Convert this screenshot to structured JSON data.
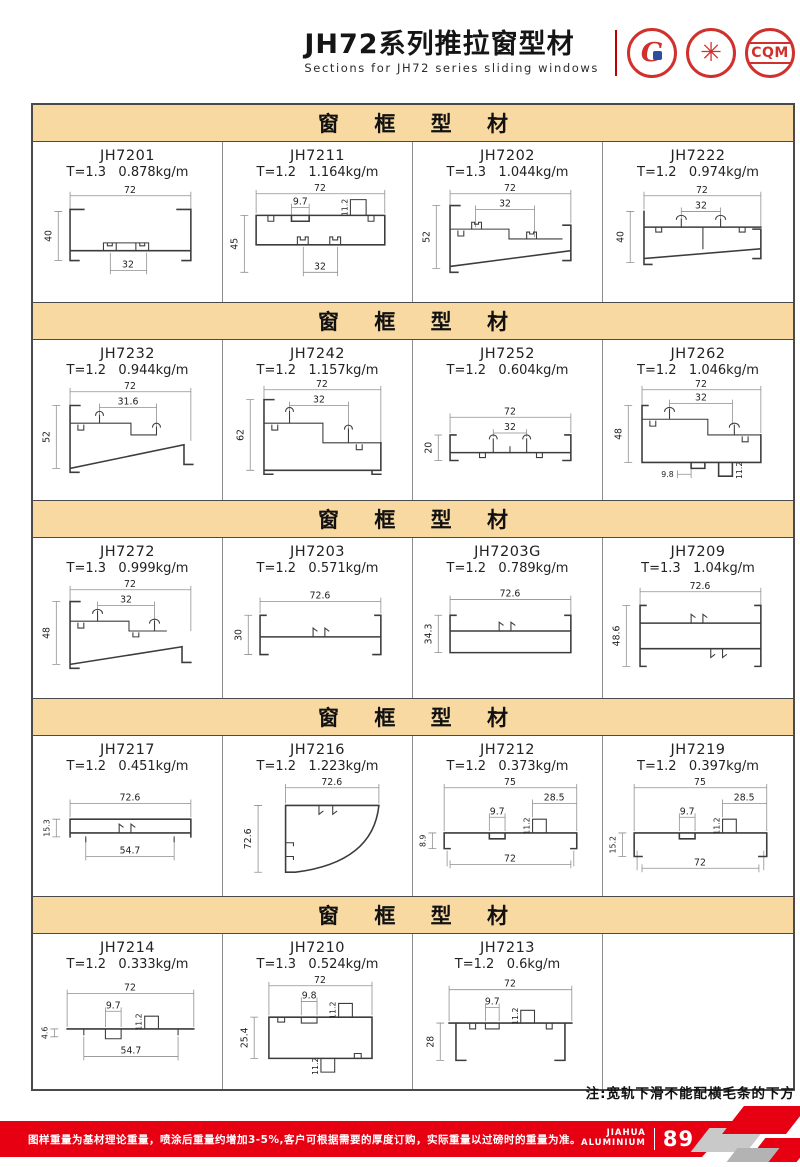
{
  "header": {
    "title": "JH72系列推拉窗型材",
    "subtitle": "Sections for JH72 series sliding windows",
    "seals": {
      "cqm_label": "CQM"
    }
  },
  "sections": [
    {
      "title": "窗 框 型 材",
      "cells": [
        {
          "model": "JH7201",
          "spec": "T=1.3   0.878kg/m",
          "dims": {
            "w": "72",
            "h": "40",
            "a": "32"
          }
        },
        {
          "model": "JH7211",
          "spec": "T=1.2   1.164kg/m",
          "dims": {
            "w": "72",
            "h": "45",
            "a": "9.7",
            "b": "11.2",
            "c": "32"
          }
        },
        {
          "model": "JH7202",
          "spec": "T=1.3   1.044kg/m",
          "dims": {
            "w": "72",
            "h": "52",
            "a": "32"
          }
        },
        {
          "model": "JH7222",
          "spec": "T=1.2   0.974kg/m",
          "dims": {
            "w": "72",
            "h": "40",
            "a": "32"
          }
        }
      ]
    },
    {
      "title": "窗 框 型 材",
      "cells": [
        {
          "model": "JH7232",
          "spec": "T=1.2   0.944kg/m",
          "dims": {
            "w": "72",
            "h": "52",
            "a": "31.6"
          }
        },
        {
          "model": "JH7242",
          "spec": "T=1.2   1.157kg/m",
          "dims": {
            "w": "72",
            "h": "62",
            "a": "32"
          }
        },
        {
          "model": "JH7252",
          "spec": "T=1.2   0.604kg/m",
          "dims": {
            "w": "72",
            "h": "20",
            "a": "32"
          }
        },
        {
          "model": "JH7262",
          "spec": "T=1.2   1.046kg/m",
          "dims": {
            "w": "72",
            "h": "48",
            "a": "32",
            "b": "9.8",
            "c": "11.2"
          }
        }
      ]
    },
    {
      "title": "窗 框 型 材",
      "cells": [
        {
          "model": "JH7272",
          "spec": "T=1.3   0.999kg/m",
          "dims": {
            "w": "72",
            "h": "48",
            "a": "32"
          }
        },
        {
          "model": "JH7203",
          "spec": "T=1.2   0.571kg/m",
          "dims": {
            "w": "72.6",
            "h": "30"
          }
        },
        {
          "model": "JH7203G",
          "spec": "T=1.2   0.789kg/m",
          "dims": {
            "w": "72.6",
            "h": "34.3"
          }
        },
        {
          "model": "JH7209",
          "spec": "T=1.3   1.04kg/m",
          "dims": {
            "w": "72.6",
            "h": "48.6"
          }
        }
      ]
    },
    {
      "title": "窗 框 型 材",
      "cells": [
        {
          "model": "JH7217",
          "spec": "T=1.2   0.451kg/m",
          "dims": {
            "w": "72.6",
            "h": "15.3",
            "a": "54.7"
          }
        },
        {
          "model": "JH7216",
          "spec": "T=1.2   1.223kg/m",
          "dims": {
            "w": "72.6",
            "h": "72.6"
          }
        },
        {
          "model": "JH7212",
          "spec": "T=1.2   0.373kg/m",
          "dims": {
            "w": "75",
            "h": "8.9",
            "a": "28.5",
            "b": "9.7",
            "c": "11.2",
            "d": "72"
          }
        },
        {
          "model": "JH7219",
          "spec": "T=1.2   0.397kg/m",
          "dims": {
            "w": "75",
            "h": "15.2",
            "a": "28.5",
            "b": "9.7",
            "c": "11.2",
            "d": "72"
          }
        }
      ]
    },
    {
      "title": "窗 框 型 材",
      "cells": [
        {
          "model": "JH7214",
          "spec": "T=1.2   0.333kg/m",
          "dims": {
            "w": "72",
            "h": "4.6",
            "a": "9.7",
            "b": "11.2",
            "c": "54.7"
          }
        },
        {
          "model": "JH7210",
          "spec": "T=1.3   0.524kg/m",
          "dims": {
            "w": "72",
            "h": "25.4",
            "a": "9.8",
            "b": "11.2",
            "c": "11.2"
          }
        },
        {
          "model": "JH7213",
          "spec": "T=1.2   0.6kg/m",
          "dims": {
            "w": "72",
            "h": "28",
            "a": "9.7",
            "b": "11.2"
          }
        }
      ]
    }
  ],
  "note": "注:宽轨下滑不能配横毛条的下方",
  "footer": {
    "disclaimer": "图样重量为基材理论重量，喷涂后重量约增加3-5%,客户可根据需要的厚度订购，实际重量以过磅时的重量为准。",
    "brand_top": "JIAHUA",
    "brand_bottom": "ALUMINIUM",
    "page_number": "89"
  },
  "colors": {
    "accent_red": "#e60012",
    "band_tan": "#f8d9a2",
    "seal_red": "#d0312d"
  }
}
